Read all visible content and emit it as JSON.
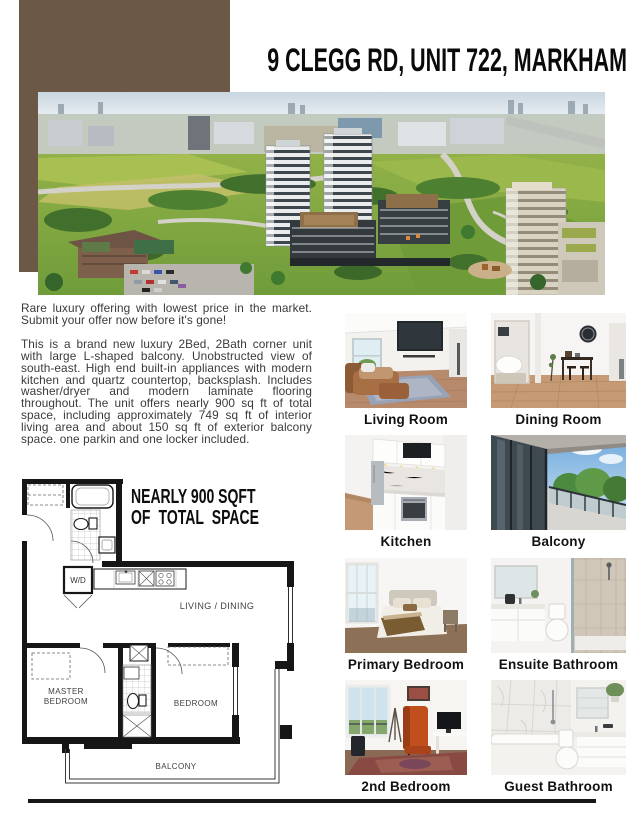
{
  "header": {
    "title": "9 CLEGG RD, UNIT 722, MARKHAM"
  },
  "intro": {
    "p1": "Rare luxury offering with lowest price in the market. Submit your offer now before it's gone!",
    "p2": "This is a brand new luxury 2Bed, 2Bath corner unit with large L-shaped balcony. Unobstructed view of south-east. High end built-in appliances with modern kitchen and quartz countertop, backsplash. Includes washer/dryer and modern laminate flooring throughout. The unit offers nearly 900 sq ft of total space, including approximately 749 sq ft of interior living area and about 150 sq ft of exterior balcony space. one parkin and one locker included."
  },
  "floorplan": {
    "headline1": "NEARLY 900 SQFT",
    "headline2": "OF TOTAL SPACE",
    "label_wd": "W/D",
    "label_living": "LIVING / DINING",
    "label_master1": "MASTER",
    "label_master2": "BEDROOM",
    "label_bedroom": "BEDROOM",
    "label_balcony": "BALCONY"
  },
  "gallery": {
    "items": [
      {
        "label": "Living Room"
      },
      {
        "label": "Dining Room"
      },
      {
        "label": "Kitchen"
      },
      {
        "label": "Balcony"
      },
      {
        "label": "Primary Bedroom"
      },
      {
        "label": "Ensuite Bathroom"
      },
      {
        "label": "2nd Bedroom"
      },
      {
        "label": "Guest Bathroom"
      }
    ]
  },
  "colors": {
    "accent_brown": "#6b5846",
    "body_text": "#3a3a3a",
    "caption_text": "#121212",
    "rule": "#161616"
  }
}
